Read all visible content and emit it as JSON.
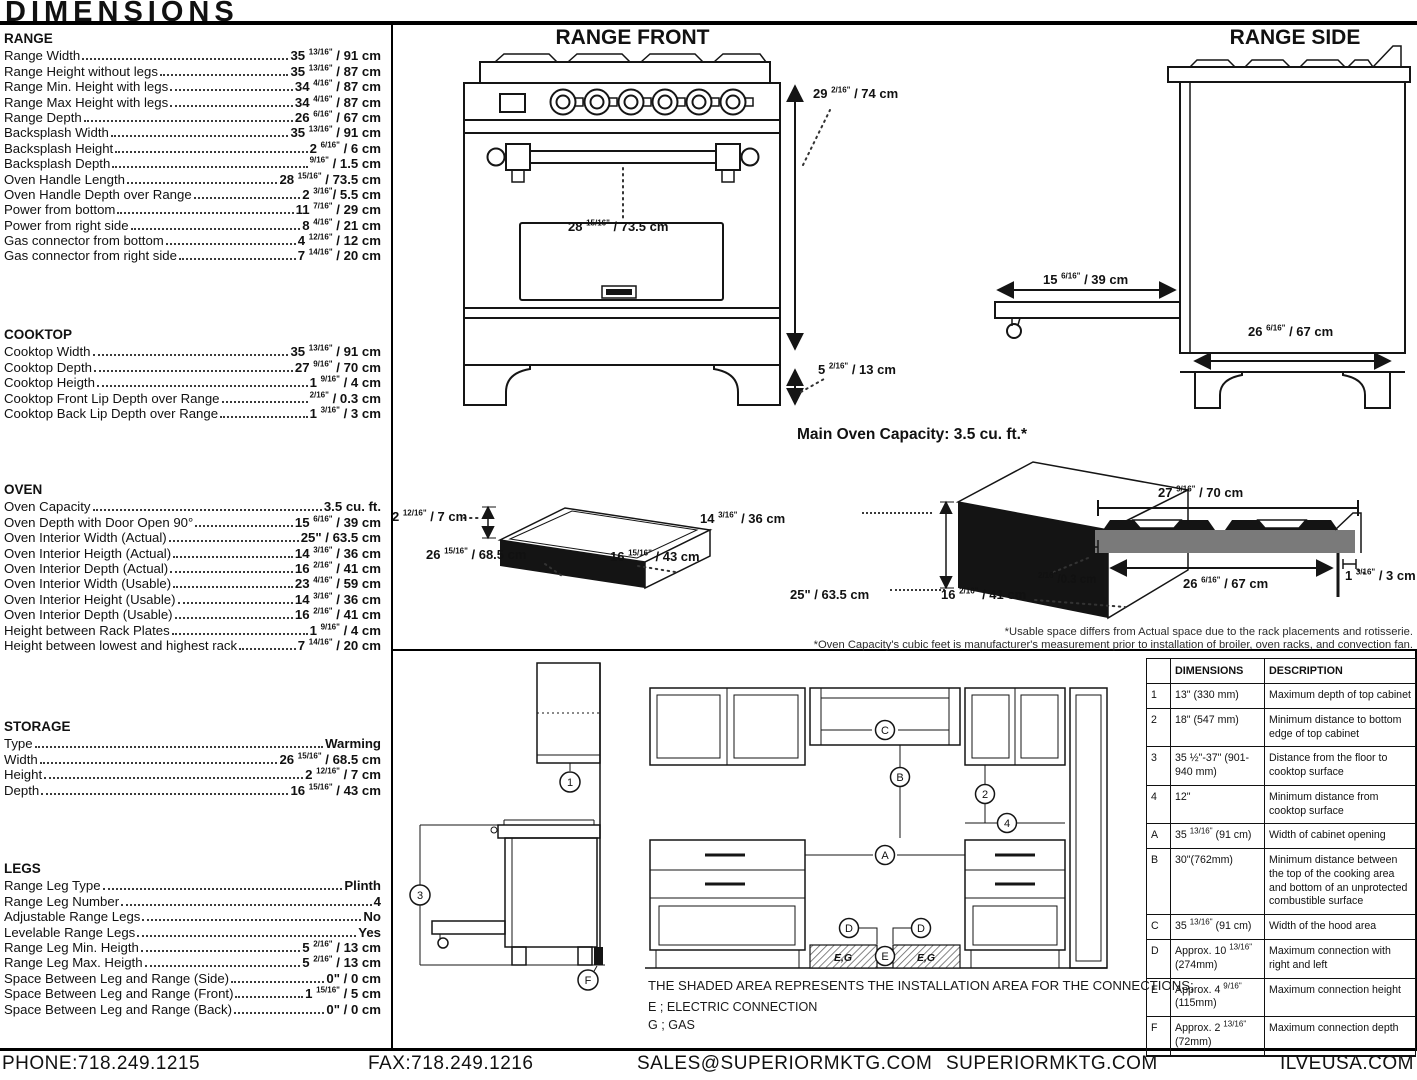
{
  "title": "DIMENSIONS",
  "specs": {
    "sections": [
      {
        "heading": "RANGE",
        "rows": [
          {
            "label": "Range Width",
            "value": "35 13/16\" / 91 cm"
          },
          {
            "label": "Range Height without legs",
            "value": "35 13/16\" / 87 cm"
          },
          {
            "label": "Range Min. Height with legs",
            "value": "34 4/16\" / 87 cm"
          },
          {
            "label": "Range Max Height with legs",
            "value": "34 4/16\" / 87 cm"
          },
          {
            "label": "Range Depth",
            "value": "26 6/16\" / 67 cm"
          },
          {
            "label": "Backsplash Width",
            "value": "35 13/16\" / 91 cm"
          },
          {
            "label": "Backsplash Height",
            "value": "2 6/16\" / 6 cm"
          },
          {
            "label": "Backsplash Depth",
            "value": "9/16\" / 1.5 cm"
          },
          {
            "label": "Oven Handle Length",
            "value": "28 15/16\" / 73.5 cm"
          },
          {
            "label": "Oven Handle Depth over Range",
            "value": "2 3/16\"/ 5.5 cm"
          },
          {
            "label": "Power from bottom",
            "value": "11 7/16\" / 29 cm"
          },
          {
            "label": "Power from right side",
            "value": "8 4/16\" / 21 cm"
          },
          {
            "label": "Gas connector from bottom",
            "value": "4 12/16\" / 12 cm"
          },
          {
            "label": "Gas connector from right side",
            "value": "7 14/16\" / 20 cm"
          }
        ]
      },
      {
        "heading": "COOKTOP",
        "rows": [
          {
            "label": "Cooktop Width",
            "value": "35 13/16\" / 91 cm"
          },
          {
            "label": "Cooktop Depth",
            "value": "27 9/16\" / 70 cm"
          },
          {
            "label": "Cooktop Heigth",
            "value": "1 9/16\" / 4 cm"
          },
          {
            "label": "Cooktop Front Lip Depth over Range",
            "value": "2/16\" / 0.3 cm"
          },
          {
            "label": "Cooktop Back Lip Depth over Range",
            "value": "1 3/16\" / 3 cm"
          }
        ]
      },
      {
        "heading": "OVEN",
        "rows": [
          {
            "label": "Oven Capacity",
            "value": "3.5 cu. ft."
          },
          {
            "label": "Oven Depth with Door Open 90°",
            "value": "15 6/16\" / 39 cm"
          },
          {
            "label": "Oven Interior Width (Actual)",
            "value": "25\" / 63.5 cm"
          },
          {
            "label": "Oven Interior Heigth (Actual)",
            "value": "14 3/16\" / 36 cm"
          },
          {
            "label": "Oven Interior Depth (Actual)",
            "value": "16 2/16\" / 41 cm"
          },
          {
            "label": "Oven Interior Width (Usable)",
            "value": "23 4/16\" / 59 cm"
          },
          {
            "label": "Oven Interior Height (Usable)",
            "value": "14 3/16\" / 36 cm"
          },
          {
            "label": "Oven Interior Depth (Usable)",
            "value": "16 2/16\" / 41 cm"
          },
          {
            "label": "Height between Rack Plates",
            "value": "1 9/16\" / 4 cm"
          },
          {
            "label": "Height between lowest and highest rack",
            "value": "7 14/16\" / 20 cm"
          }
        ]
      },
      {
        "heading": "STORAGE",
        "rows": [
          {
            "label": "Type",
            "value": "Warming"
          },
          {
            "label": "Width",
            "value": "26 15/16\" / 68.5 cm"
          },
          {
            "label": "Height",
            "value": "2 12/16\" / 7 cm"
          },
          {
            "label": "Depth",
            "value": "16 15/16\" / 43 cm"
          }
        ]
      },
      {
        "heading": "LEGS",
        "rows": [
          {
            "label": "Range Leg Type",
            "value": "Plinth"
          },
          {
            "label": "Range Leg Number",
            "value": "4"
          },
          {
            "label": "Adjustable Range Legs",
            "value": "No"
          },
          {
            "label": "Levelable Range Legs",
            "value": "Yes"
          },
          {
            "label": "Range Leg Min. Heigth",
            "value": "5 2/16\" / 13 cm"
          },
          {
            "label": "Range Leg Max. Heigth",
            "value": "5 2/16\" / 13 cm"
          },
          {
            "label": "Space Between Leg and Range (Side)",
            "value": "0\" / 0 cm"
          },
          {
            "label": "Space Between Leg and Range (Front)",
            "value": "1 15/16\" / 5 cm"
          },
          {
            "label": "Space Between Leg and Range (Back)",
            "value": "0\" / 0 cm"
          }
        ]
      }
    ]
  },
  "front": {
    "title": "RANGE FRONT",
    "dim_height": "29 2/16\" / 74 cm",
    "dim_handle": "28 15/16\" / 73.5 cm",
    "dim_leg": "5 2/16\" / 13 cm"
  },
  "side": {
    "title": "RANGE SIDE",
    "dim_door": "15 6/16\" / 39 cm",
    "dim_depth": "26 6/16\" / 67 cm"
  },
  "capacity": {
    "title": "Main Oven Capacity: 3.5 cu. ft.*",
    "drawer": {
      "h": "2 12/16\" / 7 cm",
      "w": "26 15/16\" / 68.5 cm",
      "d": "16 15/16\" / 43 cm"
    },
    "oven": {
      "h": "14 3/16\" / 36 cm",
      "w": "25\" / 63.5 cm",
      "d": "16 2/16\" / 41 cm"
    },
    "cooktop": {
      "top": "27 9/16\" / 70 cm",
      "bottom": "26 6/16\" / 67 cm",
      "left": "2/16\"/0.3 cm",
      "right": "1 3/16\" / 3 cm"
    },
    "footnote1": "*Usable space differs from Actual space due to the rack placements and rotisserie.",
    "footnote2": "*Oven Capacity's cubic feet is manufacturer's measurement prior to installation of broiler, oven racks, and convection fan."
  },
  "installation": {
    "note": "THE SHADED AREA REPRESENTS THE INSTALLATION AREA FOR THE CONNECTIONS;",
    "legend_electric": "E ; ELECTRIC CONNECTION",
    "legend_gas": "G ; GAS",
    "shaded_label": "E,G",
    "markers": {
      "n1": "1",
      "n2": "2",
      "n3": "3",
      "n4": "4",
      "a": "A",
      "b": "B",
      "c": "C",
      "d": "D",
      "e": "E",
      "f": "F"
    },
    "table": {
      "col_dimensions": "DIMENSIONS",
      "col_description": "DESCRIPTION",
      "rows": [
        {
          "id": "1",
          "dims": "13\" (330 mm)",
          "desc": "Maximum depth of top cabinet"
        },
        {
          "id": "2",
          "dims": "18\" (547 mm)",
          "desc": "Minimum distance to bottom edge of top cabinet"
        },
        {
          "id": "3",
          "dims": "35 ½\"-37\" (901-940 mm)",
          "desc": "Distance from the floor to cooktop surface"
        },
        {
          "id": "4",
          "dims": "12\"",
          "desc": "Minimum distance from cooktop surface"
        },
        {
          "id": "A",
          "dims": "35 13/16\" (91 cm)",
          "desc": "Width of cabinet opening"
        },
        {
          "id": "B",
          "dims": "30\"(762mm)",
          "desc": "Minimum distance between the top of the cooking area and bottom of an unprotected combustible surface"
        },
        {
          "id": "C",
          "dims": "35 13/16\" (91 cm)",
          "desc": "Width of the hood area"
        },
        {
          "id": "D",
          "dims": "Approx. 10 13/16\" (274mm)",
          "desc": "Maximum connection with right and left"
        },
        {
          "id": "E",
          "dims": "Approx. 4 9/16\" (115mm)",
          "desc": "Maximum connection height"
        },
        {
          "id": "F",
          "dims": "Approx. 2 13/16\" (72mm)",
          "desc": "Maximum connection depth"
        }
      ]
    }
  },
  "footer": {
    "phone": "PHONE:718.249.1215",
    "fax": "FAX:718.249.1216",
    "email": "SALES@SUPERIORMKTG.COM",
    "site": "SUPERIORMKTG.COM",
    "site2": "ILVEUSA.COM"
  }
}
